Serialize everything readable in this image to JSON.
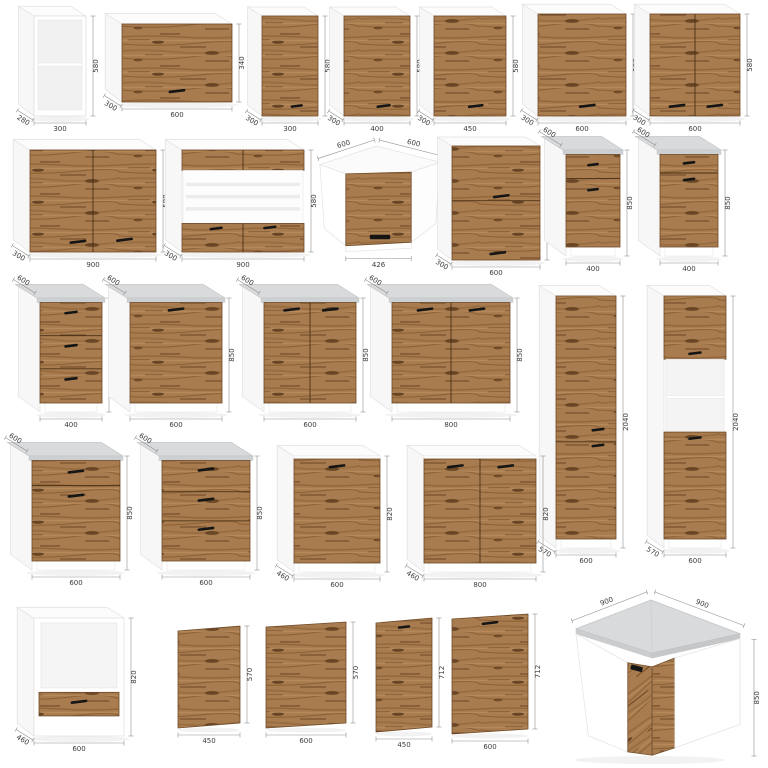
{
  "page": {
    "background": "#ffffff",
    "description": "Catalog sheet of kitchen cabinet modules with dimensions in mm"
  },
  "colors": {
    "wood_base": "#a87c4e",
    "wood_streak_dark": "#6b4625",
    "wood_streak_light": "#bf9464",
    "carcass_white": "#ffffff",
    "side_shade": "#f7f7f7",
    "countertop": "#d8dadc",
    "handle": "#151515",
    "dim_line": "#8f8f8f",
    "dim_text": "#3b3b3b",
    "background": "#ffffff"
  },
  "cabinets": [
    {
      "id": "cabinet-wall-open-300",
      "kind": "box",
      "dims": {
        "width_mm": 300,
        "height_mm": 580,
        "depth_mm": 280
      },
      "draw": {
        "x": 34,
        "y": 16,
        "w": 52,
        "h": 100,
        "d": 13,
        "top": "white",
        "front": "open"
      },
      "labels": [
        {
          "t": "580",
          "p": "right"
        },
        {
          "t": "300",
          "p": "bottom"
        },
        {
          "t": "280",
          "p": "depth-bl"
        }
      ]
    },
    {
      "id": "cabinet-wall-flip-600x340",
      "kind": "box",
      "dims": {
        "width_mm": 600,
        "height_mm": 340,
        "depth_mm": 300
      },
      "draw": {
        "x": 122,
        "y": 24,
        "w": 110,
        "h": 78,
        "d": 14,
        "top": "white",
        "front": "wood",
        "handles": [
          [
            0.5,
            0.86
          ]
        ]
      },
      "labels": [
        {
          "t": "340",
          "p": "right"
        },
        {
          "t": "600",
          "p": "bottom"
        },
        {
          "t": "300",
          "p": "depth-bl"
        }
      ]
    },
    {
      "id": "cabinet-wall-300x580",
      "kind": "box",
      "dims": {
        "width_mm": 300,
        "height_mm": 580,
        "depth_mm": 300
      },
      "draw": {
        "x": 262,
        "y": 16,
        "w": 56,
        "h": 100,
        "d": 12,
        "top": "white",
        "front": "wood",
        "handles": [
          [
            0.62,
            0.9
          ]
        ]
      },
      "labels": [
        {
          "t": "580",
          "p": "right"
        },
        {
          "t": "300",
          "p": "bottom"
        },
        {
          "t": "300",
          "p": "depth-bl"
        }
      ]
    },
    {
      "id": "cabinet-wall-400x580",
      "kind": "box",
      "dims": {
        "width_mm": 400,
        "height_mm": 580,
        "depth_mm": 300
      },
      "draw": {
        "x": 344,
        "y": 16,
        "w": 66,
        "h": 100,
        "d": 12,
        "top": "white",
        "front": "wood",
        "handles": [
          [
            0.6,
            0.9
          ]
        ]
      },
      "labels": [
        {
          "t": "580",
          "p": "right"
        },
        {
          "t": "400",
          "p": "bottom"
        },
        {
          "t": "300",
          "p": "depth-bl"
        }
      ]
    },
    {
      "id": "cabinet-wall-450x580",
      "kind": "box",
      "dims": {
        "width_mm": 450,
        "height_mm": 580,
        "depth_mm": 300
      },
      "draw": {
        "x": 434,
        "y": 16,
        "w": 72,
        "h": 100,
        "d": 12,
        "top": "white",
        "front": "wood",
        "handles": [
          [
            0.58,
            0.9
          ]
        ]
      },
      "labels": [
        {
          "t": "580",
          "p": "right"
        },
        {
          "t": "450",
          "p": "bottom"
        },
        {
          "t": "300",
          "p": "depth-bl"
        }
      ]
    },
    {
      "id": "cabinet-wall-600x580",
      "kind": "box",
      "dims": {
        "width_mm": 600,
        "height_mm": 580,
        "depth_mm": 300
      },
      "draw": {
        "x": 538,
        "y": 14,
        "w": 88,
        "h": 102,
        "d": 13,
        "top": "white",
        "front": "wood",
        "handles": [
          [
            0.56,
            0.9
          ]
        ]
      },
      "labels": [
        {
          "t": "580",
          "p": "right"
        },
        {
          "t": "600",
          "p": "bottom"
        },
        {
          "t": "300",
          "p": "depth-bl"
        }
      ]
    },
    {
      "id": "cabinet-wall-600x580-2door",
      "kind": "box",
      "dims": {
        "width_mm": 600,
        "height_mm": 580,
        "depth_mm": 300
      },
      "draw": {
        "x": 650,
        "y": 14,
        "w": 90,
        "h": 102,
        "d": 13,
        "top": "white",
        "front": "wood",
        "divider": true,
        "handles": [
          [
            0.3,
            0.9
          ],
          [
            0.72,
            0.9
          ]
        ]
      },
      "labels": [
        {
          "t": "580",
          "p": "right"
        },
        {
          "t": "600",
          "p": "bottom"
        },
        {
          "t": "300",
          "p": "depth-bl"
        }
      ]
    },
    {
      "id": "cabinet-wall-900x580-2door",
      "kind": "box",
      "dims": {
        "width_mm": 900,
        "height_mm": 580,
        "depth_mm": 300
      },
      "draw": {
        "x": 30,
        "y": 150,
        "w": 126,
        "h": 102,
        "d": 14,
        "top": "white",
        "front": "wood",
        "divider": true,
        "handles": [
          [
            0.38,
            0.9
          ],
          [
            0.75,
            0.88
          ]
        ]
      },
      "labels": [
        {
          "t": "580",
          "p": "right"
        },
        {
          "t": "900",
          "p": "bottom"
        },
        {
          "t": "300",
          "p": "depth-bl"
        }
      ]
    },
    {
      "id": "cabinet-wall-900x580-glass",
      "kind": "box",
      "dims": {
        "width_mm": 900,
        "height_mm": 580,
        "depth_mm": 300
      },
      "draw": {
        "x": 182,
        "y": 150,
        "w": 122,
        "h": 102,
        "d": 14,
        "top": "white",
        "front": "glass"
      },
      "labels": [
        {
          "t": "580",
          "p": "right"
        },
        {
          "t": "900",
          "p": "bottom"
        },
        {
          "t": "300",
          "p": "depth-bl"
        }
      ]
    },
    {
      "id": "cabinet-wall-corner-600x600",
      "kind": "corner-wall",
      "dims": {
        "width_mm": 600,
        "depth_mm": 600,
        "height_mm": 580,
        "door_width_mm": 426
      },
      "draw": {
        "x": 320,
        "y": 146,
        "w": 120,
        "h": 116
      },
      "labels": [
        {
          "t": "600",
          "p": "tl-slant"
        },
        {
          "t": "600",
          "p": "tr-slant"
        },
        {
          "t": "580",
          "p": "right"
        },
        {
          "t": "426",
          "p": "door"
        }
      ]
    },
    {
      "id": "cabinet-wall-600x720-2door",
      "kind": "box",
      "dims": {
        "width_mm": 600,
        "height_mm": 720,
        "depth_mm": 300
      },
      "draw": {
        "x": 452,
        "y": 146,
        "w": 88,
        "h": 114,
        "d": 12,
        "top": "white",
        "front": "wood",
        "splits": [
          0.48
        ],
        "handles": [
          [
            0.56,
            0.44
          ],
          [
            0.52,
            0.94
          ]
        ]
      },
      "labels": [
        {
          "t": "720",
          "p": "right"
        },
        {
          "t": "600",
          "p": "bottom"
        },
        {
          "t": "300",
          "p": "depth-bl"
        }
      ]
    },
    {
      "id": "cabinet-base-400-drawer-door-a",
      "kind": "box",
      "dims": {
        "width_mm": 400,
        "height_mm": 850,
        "depth_mm": 600
      },
      "draw": {
        "x": 566,
        "y": 150,
        "w": 54,
        "h": 106,
        "d": 18,
        "top": "counter",
        "plinth": true,
        "splits": [
          0.26
        ],
        "handles": [
          [
            0.5,
            0.11
          ],
          [
            0.5,
            0.38
          ]
        ]
      },
      "labels": [
        {
          "t": "600",
          "p": "depth-tl"
        },
        {
          "t": "850",
          "p": "right"
        },
        {
          "t": "400",
          "p": "bottom"
        }
      ]
    },
    {
      "id": "cabinet-base-400-drawer-door-b",
      "kind": "box",
      "dims": {
        "width_mm": 400,
        "height_mm": 850,
        "depth_mm": 600
      },
      "draw": {
        "x": 660,
        "y": 150,
        "w": 58,
        "h": 106,
        "d": 18,
        "top": "counter",
        "plinth": true,
        "splits": [
          0.2
        ],
        "handles": [
          [
            0.5,
            0.09
          ],
          [
            0.5,
            0.27
          ]
        ]
      },
      "labels": [
        {
          "t": "600",
          "p": "depth-tl"
        },
        {
          "t": "850",
          "p": "right"
        },
        {
          "t": "400",
          "p": "bottom"
        }
      ]
    },
    {
      "id": "cabinet-base-400-3drawers",
      "kind": "box",
      "dims": {
        "width_mm": 400,
        "height_mm": 850,
        "depth_mm": 600
      },
      "draw": {
        "x": 40,
        "y": 298,
        "w": 62,
        "h": 114,
        "d": 18,
        "top": "counter",
        "plinth": true,
        "splits": [
          0.33,
          0.66
        ],
        "handles": [
          [
            0.5,
            0.1
          ],
          [
            0.5,
            0.43
          ],
          [
            0.5,
            0.76
          ]
        ]
      },
      "labels": [
        {
          "t": "600",
          "p": "depth-tl"
        },
        {
          "t": "850",
          "p": "right"
        },
        {
          "t": "400",
          "p": "bottom"
        }
      ]
    },
    {
      "id": "cabinet-base-600-1door",
      "kind": "box",
      "dims": {
        "width_mm": 600,
        "height_mm": 850,
        "depth_mm": 600
      },
      "draw": {
        "x": 130,
        "y": 298,
        "w": 92,
        "h": 114,
        "d": 18,
        "top": "counter",
        "plinth": true,
        "handles": [
          [
            0.5,
            0.07
          ]
        ]
      },
      "labels": [
        {
          "t": "600",
          "p": "depth-tl"
        },
        {
          "t": "850",
          "p": "right"
        },
        {
          "t": "600",
          "p": "bottom"
        }
      ]
    },
    {
      "id": "cabinet-base-600-2door",
      "kind": "box",
      "dims": {
        "width_mm": 600,
        "height_mm": 850,
        "depth_mm": 600
      },
      "draw": {
        "x": 264,
        "y": 298,
        "w": 92,
        "h": 114,
        "d": 18,
        "top": "counter",
        "plinth": true,
        "divider": true,
        "handles": [
          [
            0.3,
            0.07
          ],
          [
            0.72,
            0.07
          ]
        ]
      },
      "labels": [
        {
          "t": "600",
          "p": "depth-tl"
        },
        {
          "t": "850",
          "p": "right"
        },
        {
          "t": "600",
          "p": "bottom"
        }
      ]
    },
    {
      "id": "cabinet-base-800-2door",
      "kind": "box",
      "dims": {
        "width_mm": 800,
        "height_mm": 850,
        "depth_mm": 600
      },
      "draw": {
        "x": 392,
        "y": 298,
        "w": 118,
        "h": 114,
        "d": 18,
        "top": "counter",
        "plinth": true,
        "divider": true,
        "handles": [
          [
            0.28,
            0.07
          ],
          [
            0.72,
            0.07
          ]
        ]
      },
      "labels": [
        {
          "t": "600",
          "p": "depth-tl"
        },
        {
          "t": "850",
          "p": "right"
        },
        {
          "t": "800",
          "p": "bottom"
        }
      ]
    },
    {
      "id": "cabinet-tall-pantry-600x2040",
      "kind": "box",
      "dims": {
        "width_mm": 600,
        "height_mm": 2040,
        "depth_mm": 570
      },
      "draw": {
        "x": 556,
        "y": 296,
        "w": 60,
        "h": 252,
        "d": 14,
        "top": "white",
        "front": "wood",
        "plinth": true,
        "splits": [
          0.6
        ],
        "handles": [
          [
            0.7,
            0.55
          ],
          [
            0.7,
            0.615
          ]
        ]
      },
      "labels": [
        {
          "t": "2040",
          "p": "right"
        },
        {
          "t": "600",
          "p": "bottom"
        },
        {
          "t": "570",
          "p": "depth-bl"
        }
      ]
    },
    {
      "id": "cabinet-tall-oven-600x2040",
      "kind": "box",
      "dims": {
        "width_mm": 600,
        "height_mm": 2040,
        "depth_mm": 570
      },
      "draw": {
        "x": 664,
        "y": 296,
        "w": 62,
        "h": 252,
        "d": 14,
        "top": "white",
        "front": "tallopen",
        "plinth": true
      },
      "labels": [
        {
          "t": "2040",
          "p": "right"
        },
        {
          "t": "600",
          "p": "bottom"
        },
        {
          "t": "570",
          "p": "depth-bl"
        }
      ]
    },
    {
      "id": "cabinet-base-600-drawer-door",
      "kind": "box",
      "dims": {
        "width_mm": 600,
        "height_mm": 850,
        "depth_mm": 600
      },
      "draw": {
        "x": 32,
        "y": 456,
        "w": 88,
        "h": 114,
        "d": 18,
        "top": "counter",
        "plinth": true,
        "splits": [
          0.25
        ],
        "handles": [
          [
            0.5,
            0.11
          ],
          [
            0.5,
            0.35
          ]
        ]
      },
      "labels": [
        {
          "t": "600",
          "p": "depth-tl"
        },
        {
          "t": "850",
          "p": "right"
        },
        {
          "t": "600",
          "p": "bottom"
        }
      ]
    },
    {
      "id": "cabinet-base-600-3drawers",
      "kind": "box",
      "dims": {
        "width_mm": 600,
        "height_mm": 850,
        "depth_mm": 600
      },
      "draw": {
        "x": 162,
        "y": 456,
        "w": 88,
        "h": 114,
        "d": 18,
        "top": "counter",
        "plinth": true,
        "splits": [
          0.31,
          0.6
        ],
        "handles": [
          [
            0.5,
            0.09
          ],
          [
            0.5,
            0.39
          ],
          [
            0.5,
            0.68
          ]
        ]
      },
      "labels": [
        {
          "t": "600",
          "p": "depth-tl"
        },
        {
          "t": "850",
          "p": "right"
        },
        {
          "t": "600",
          "p": "bottom"
        }
      ]
    },
    {
      "id": "cabinet-base-600-1door-low",
      "kind": "box",
      "dims": {
        "width_mm": 600,
        "height_mm": 820,
        "depth_mm": 460
      },
      "draw": {
        "x": 294,
        "y": 456,
        "w": 86,
        "h": 116,
        "d": 14,
        "top": "white",
        "te": 3,
        "plinth": true,
        "front": "wood",
        "handles": [
          [
            0.5,
            0.07
          ]
        ]
      },
      "labels": [
        {
          "t": "820",
          "p": "right"
        },
        {
          "t": "600",
          "p": "bottom"
        },
        {
          "t": "460",
          "p": "depth-bl"
        }
      ]
    },
    {
      "id": "cabinet-base-800-2door-low",
      "kind": "box",
      "dims": {
        "width_mm": 800,
        "height_mm": 820,
        "depth_mm": 460
      },
      "draw": {
        "x": 424,
        "y": 456,
        "w": 112,
        "h": 116,
        "d": 14,
        "top": "white",
        "te": 3,
        "plinth": true,
        "front": "wood",
        "divider": true,
        "handles": [
          [
            0.28,
            0.07
          ],
          [
            0.73,
            0.07
          ]
        ]
      },
      "labels": [
        {
          "t": "820",
          "p": "right"
        },
        {
          "t": "800",
          "p": "bottom"
        },
        {
          "t": "460",
          "p": "depth-bl"
        }
      ]
    },
    {
      "id": "cabinet-oven-housing-600",
      "kind": "box",
      "dims": {
        "width_mm": 600,
        "height_mm": 820,
        "depth_mm": 460
      },
      "draw": {
        "x": 34,
        "y": 618,
        "w": 90,
        "h": 118,
        "d": 14,
        "top": "white",
        "front": "oven"
      },
      "labels": [
        {
          "t": "820",
          "p": "right"
        },
        {
          "t": "600",
          "p": "bottom"
        },
        {
          "t": "460",
          "p": "depth-bl"
        }
      ]
    },
    {
      "id": "front-panel-450x570",
      "kind": "panel",
      "dims": {
        "width_mm": 450,
        "height_mm": 570
      },
      "draw": {
        "x": 178,
        "y": 626,
        "w": 62,
        "h": 102
      },
      "labels": [
        {
          "t": "570",
          "p": "right"
        },
        {
          "t": "450",
          "p": "bottom"
        }
      ]
    },
    {
      "id": "front-panel-600x570",
      "kind": "panel",
      "dims": {
        "width_mm": 600,
        "height_mm": 570
      },
      "draw": {
        "x": 266,
        "y": 622,
        "w": 80,
        "h": 106
      },
      "labels": [
        {
          "t": "570",
          "p": "right"
        },
        {
          "t": "600",
          "p": "bottom"
        }
      ]
    },
    {
      "id": "appliance-front-450x712",
      "kind": "panel",
      "dims": {
        "width_mm": 450,
        "height_mm": 712
      },
      "draw": {
        "x": 376,
        "y": 618,
        "w": 56,
        "h": 114,
        "handle": true
      },
      "labels": [
        {
          "t": "712",
          "p": "right"
        },
        {
          "t": "450",
          "p": "bottom"
        }
      ]
    },
    {
      "id": "appliance-front-600x712",
      "kind": "panel",
      "dims": {
        "width_mm": 600,
        "height_mm": 712
      },
      "draw": {
        "x": 452,
        "y": 614,
        "w": 76,
        "h": 120,
        "handle": true
      },
      "labels": [
        {
          "t": "712",
          "p": "right"
        },
        {
          "t": "600",
          "p": "bottom"
        }
      ]
    },
    {
      "id": "cabinet-corner-base-900x900",
      "kind": "corner-base",
      "dims": {
        "width_mm": 900,
        "depth_mm": 900,
        "height_mm": 850
      },
      "draw": {
        "x": 574,
        "y": 598,
        "w": 168,
        "h": 162
      },
      "labels": [
        {
          "t": "900",
          "p": "tl-slant"
        },
        {
          "t": "900",
          "p": "tr-slant"
        },
        {
          "t": "850",
          "p": "right"
        }
      ]
    }
  ]
}
